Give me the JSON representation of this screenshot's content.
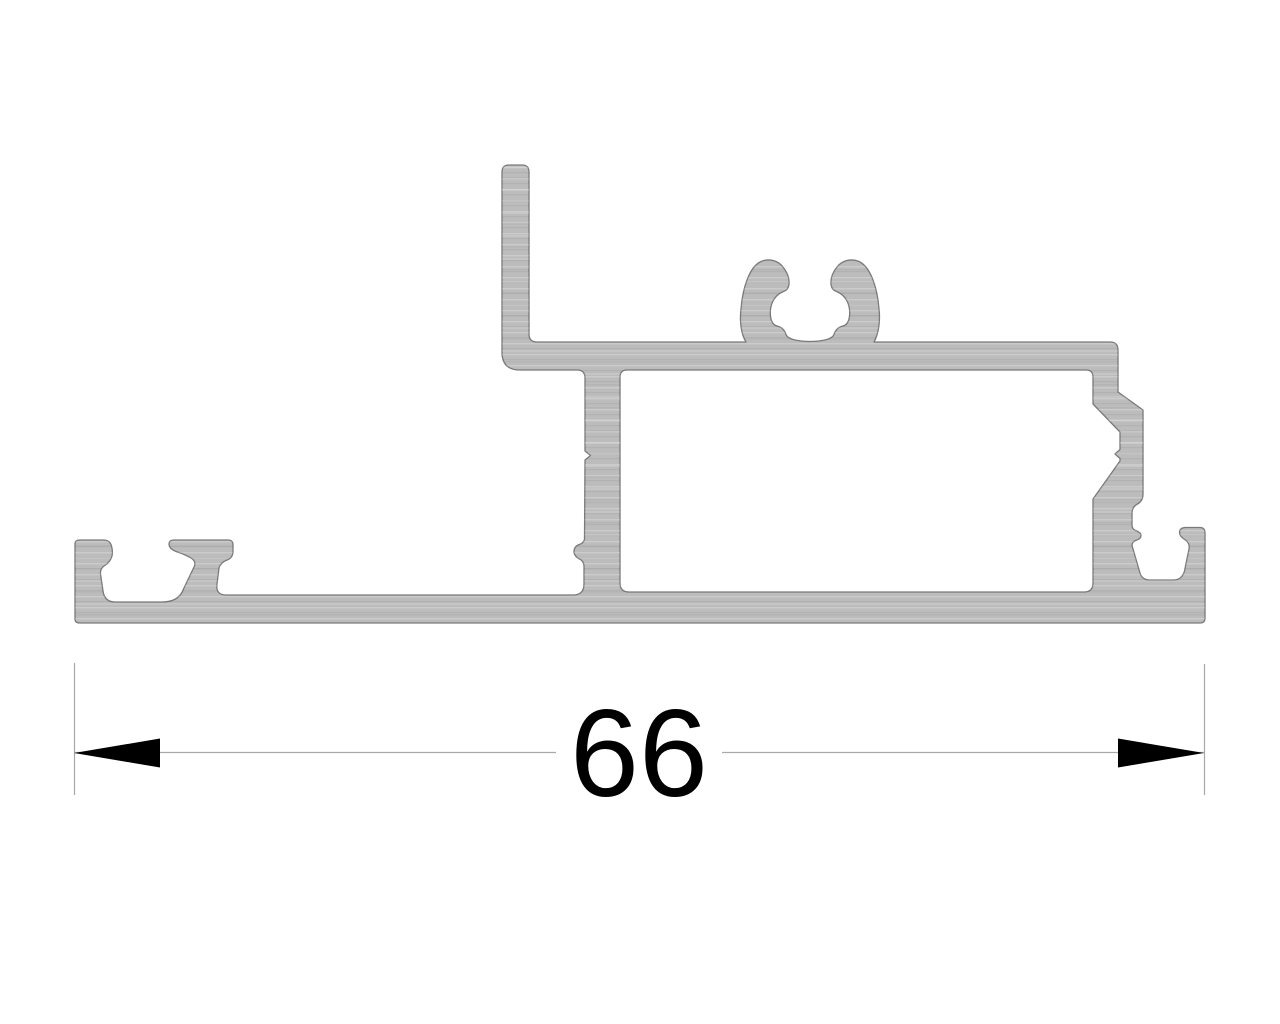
{
  "drawing": {
    "type": "extrusion-profile-cross-section",
    "dimension": {
      "value": "66"
    },
    "colors": {
      "background": "#ffffff",
      "profile_fill": "#bcbcbc",
      "profile_outline": "#7a7a7a",
      "dimension_line": "#a9a9a9",
      "extension_line": "#a9a9a9",
      "arrow": "#000000",
      "dimension_text": "#000000"
    }
  }
}
